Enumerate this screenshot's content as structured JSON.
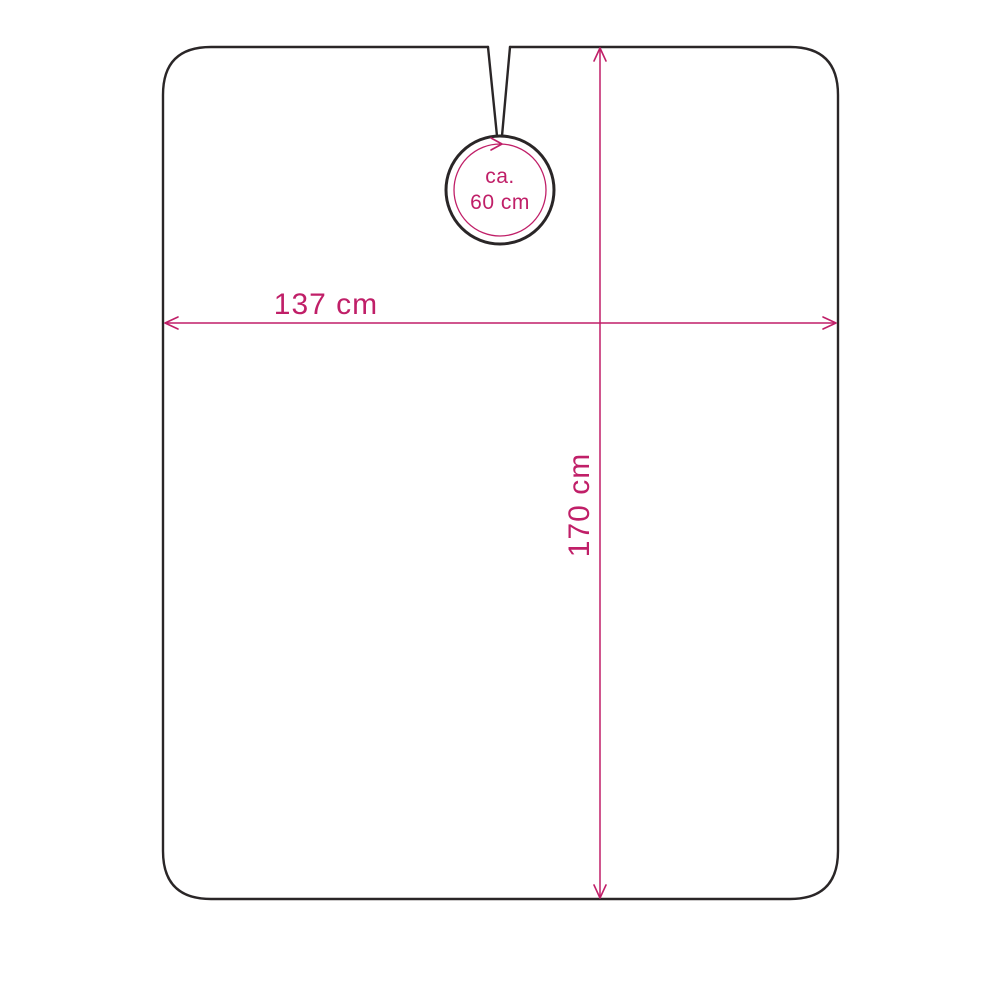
{
  "labels": {
    "width": "137 cm",
    "height": "170 cm",
    "neck_line1": "ca.",
    "neck_line2": "60 cm"
  },
  "colors": {
    "outline": "#2a2627",
    "dimension": "#c01f68",
    "background": "#ffffff"
  }
}
